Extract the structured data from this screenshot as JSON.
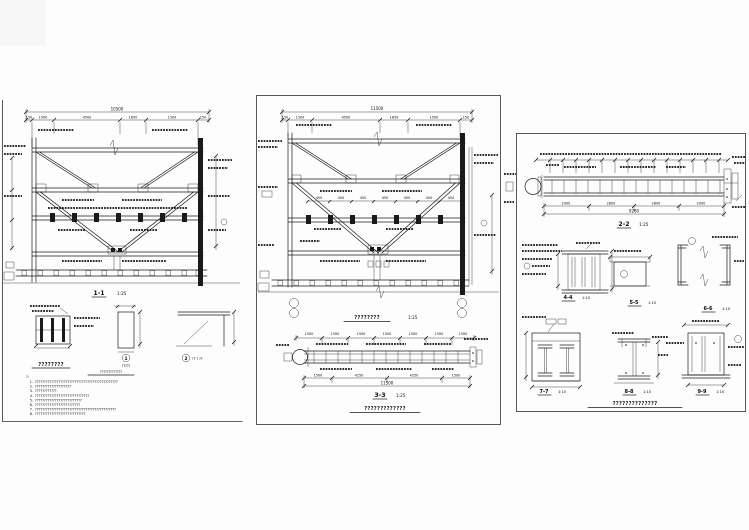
{
  "page": {
    "background": "#fdfdfd",
    "ink": "#1a1a1a"
  },
  "left_panel": {
    "overall_dim": "10500",
    "top_dims": [
      "150",
      "1500",
      "4500",
      "1850",
      "1500",
      "150"
    ],
    "section_label": "1-1",
    "section_scale": "1:25",
    "detail_column_title": "????????",
    "plate_badge": "1",
    "plate_caption": "?????",
    "plate_title": "?????????????",
    "bracket_badge": "2",
    "bracket_caption": "?? ? ??",
    "notes_header": "?:",
    "notes": [
      {
        "num": "1.",
        "text": "??????????????????????????????????????????????"
      },
      {
        "num": "2.",
        "text": "????????????????????"
      },
      {
        "num": "3.",
        "text": "????????????"
      },
      {
        "num": "4.",
        "text": "??????????????????????????????"
      },
      {
        "num": "5.",
        "text": "??????????????????????????"
      },
      {
        "num": "6.",
        "text": "?????????????????????????"
      },
      {
        "num": "7.",
        "text": "?????????????????????????????????????????????"
      },
      {
        "num": "8.",
        "text": "????????????????????????????"
      }
    ]
  },
  "middle_panel": {
    "overall_dim": "11500",
    "top_dims": [
      "150",
      "1500",
      "4500",
      "1850",
      "1500",
      "150"
    ],
    "mid_dims": [
      "450",
      "450",
      "450",
      "450",
      "450",
      "450",
      "450"
    ],
    "elevation_title": "????????",
    "elevation_scale": "1:25",
    "beam_top_dims": [
      "1500",
      "1500",
      "1500",
      "1500",
      "1500",
      "1500",
      "1500"
    ],
    "beam_bottom_dims": [
      "1500",
      "4250",
      "4250",
      "1500"
    ],
    "beam_overall": "11500",
    "beam_label": "3-3",
    "beam_scale": "1:25",
    "beam_title": "?????????????"
  },
  "right_panel": {
    "beam_label": "2-2",
    "beam_scale": "1:25",
    "beam_overall": "9280",
    "beam_bottom_dims": [
      "2000",
      "2800",
      "2800",
      "2000"
    ],
    "sections": [
      {
        "label": "4-4",
        "scale": "1:10"
      },
      {
        "label": "5-5",
        "scale": "1:10"
      },
      {
        "label": "6-6",
        "scale": "1:10"
      },
      {
        "label": "7-7",
        "scale": "1:10"
      },
      {
        "label": "8-8",
        "scale": "1:10"
      },
      {
        "label": "9-9",
        "scale": "1:10"
      }
    ],
    "footer_title": "??????????????"
  }
}
